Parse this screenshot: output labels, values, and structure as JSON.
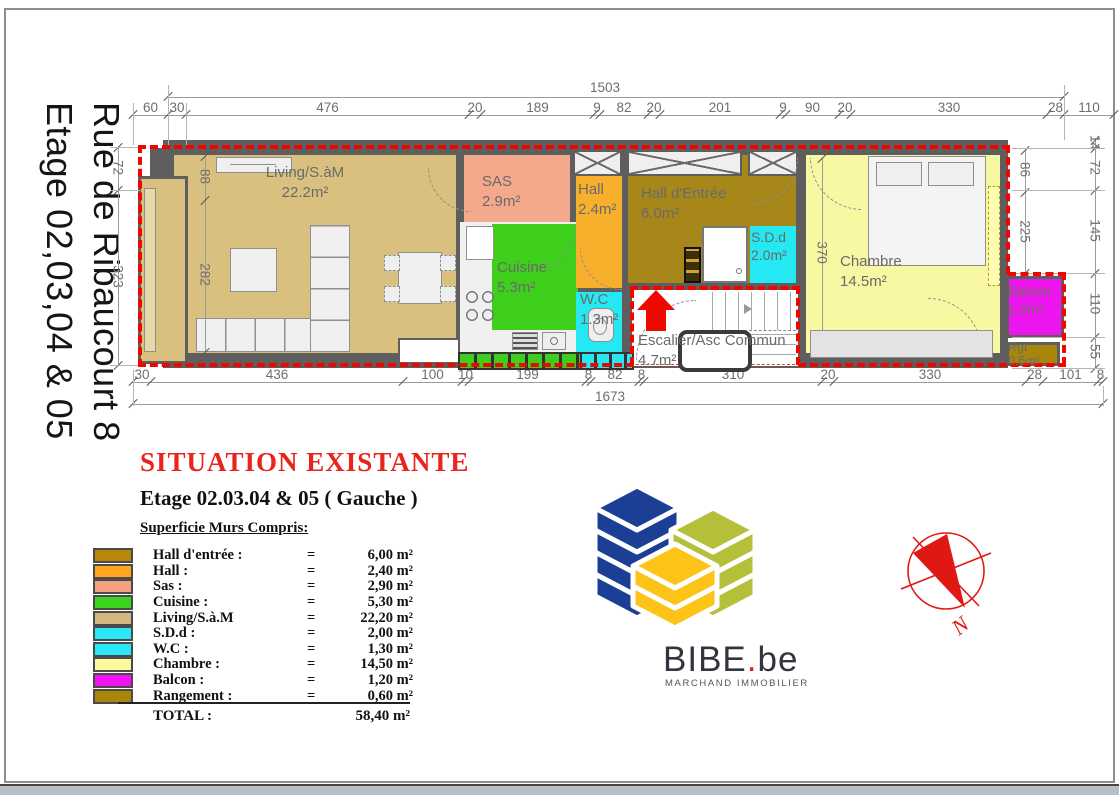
{
  "sidebar": {
    "line_right": "Rue de Ribaucourt 8",
    "line_left": "Etage 02,03,04 & 05"
  },
  "dims": {
    "top_total": "1503",
    "top_segments": [
      "60",
      "30",
      "476",
      "20",
      "189",
      "9",
      "82",
      "20",
      "201",
      "9",
      "90",
      "20",
      "330",
      "28",
      "110"
    ],
    "bottom_total": "1673",
    "bottom_segments": [
      "30",
      "436",
      "100",
      "10",
      "199",
      "8",
      "82",
      "8",
      "310",
      "20",
      "330",
      "28",
      "101",
      "8"
    ],
    "left_outer": [
      "72",
      "323"
    ],
    "left_inner": [
      "88",
      "282"
    ],
    "right_inner": [
      "86",
      "225"
    ],
    "right_outer": [
      "14",
      "72",
      "145",
      "110",
      "55"
    ],
    "chambre_height": [
      "370"
    ]
  },
  "rooms": {
    "living": {
      "name": "Living/S.àM",
      "area": "22.2m²"
    },
    "sas": {
      "name": "SAS",
      "area": "2.9m²"
    },
    "hall": {
      "name": "Hall",
      "area": "2.4m²"
    },
    "hall_entree": {
      "name": "Hall d'Entrée",
      "area": "6.0m²"
    },
    "cuisine": {
      "name": "Cuisine",
      "area": "5.3m²"
    },
    "wc": {
      "name": "W.C",
      "area": "1.3m²"
    },
    "sdd": {
      "name": "S.D.d",
      "area": "2.0m²"
    },
    "escalier": {
      "name": "Escalier/Asc Commun",
      "area": "4.7m²"
    },
    "chambre": {
      "name": "Chambre",
      "area": "14.5m²"
    },
    "balcon": {
      "name": "Balcon",
      "area": "1.2m²"
    },
    "rgt": {
      "name": "Rgt",
      "area": "0.6m²"
    }
  },
  "title_block": {
    "title": "SITUATION EXISTANTE",
    "subtitle": "Etage 02.03.04 & 05 ( Gauche )",
    "legend_heading": "Superficie Murs Compris:",
    "rows": [
      {
        "label": "Hall d'entrée :",
        "eq": "=",
        "value": "6,00 m²",
        "color": "#b8860b"
      },
      {
        "label": "Hall :",
        "eq": "=",
        "value": "2,40 m²",
        "color": "#ffa51f"
      },
      {
        "label": "Sas :",
        "eq": "=",
        "value": "2,90 m²",
        "color": "#f4a083"
      },
      {
        "label": "Cuisine :",
        "eq": "=",
        "value": "5,30 m²",
        "color": "#3dd41d"
      },
      {
        "label": "Living/S.à.M",
        "eq": "=",
        "value": "22,20 m²",
        "color": "#d2b97f"
      },
      {
        "label": "S.D.d :",
        "eq": "=",
        "value": "2,00 m²",
        "color": "#29e8f5"
      },
      {
        "label": "W.C :",
        "eq": "=",
        "value": "1,30 m²",
        "color": "#29e8f5"
      },
      {
        "label": "Chambre :",
        "eq": "=",
        "value": "14,50 m²",
        "color": "#fbfa9c"
      },
      {
        "label": "Balcon :",
        "eq": "=",
        "value": "1,20 m²",
        "color": "#f014f0"
      },
      {
        "label": "Rangement :",
        "eq": "=",
        "value": "0,60 m²",
        "color": "#a8860b"
      }
    ],
    "total_label": "TOTAL :",
    "total_value": "58,40 m²"
  },
  "logo": {
    "name": "BIBE",
    "dot": ".",
    "tld": "be",
    "tagline": "MARCHAND IMMOBILIER",
    "colors": {
      "blue": "#1b3f94",
      "olive": "#b6bf3a",
      "yellow": "#fdc417",
      "red": "#e02020"
    }
  },
  "compass": {
    "label": "N"
  }
}
